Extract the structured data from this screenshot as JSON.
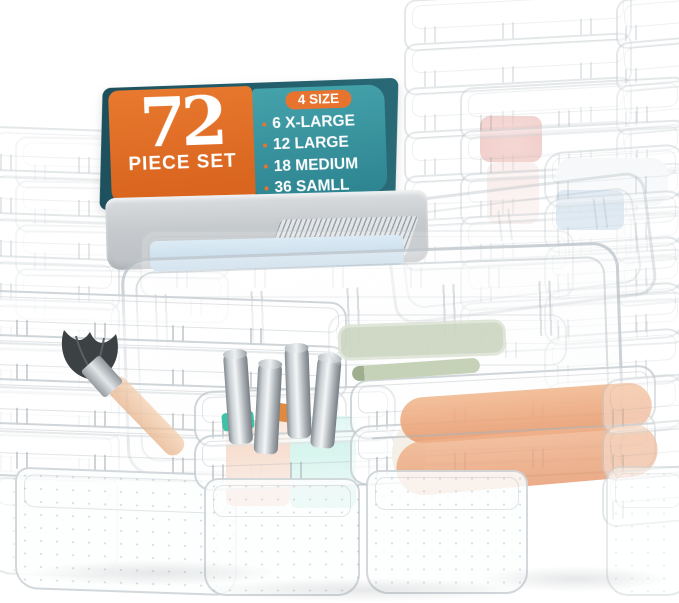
{
  "banner": {
    "piece_count": "72",
    "piece_count_label": "PIECE SET",
    "size_badge": "4 SIZE",
    "sizes": [
      "6 X-LARGE",
      "12 LARGE",
      "18 MEDIUM",
      "36 SAMLL"
    ],
    "colors": {
      "orange": "#DD6B2D",
      "teal": "#35909D",
      "dark_teal": "#1E515E",
      "text_white": "#FFFFFF"
    }
  },
  "scene": {
    "object_names": [
      "clear-organizer-tray-stacks",
      "gray-organizer-tray",
      "makeup-brush",
      "silver-lipstick-tubes",
      "peach-cosmetic-rolls",
      "mint-cosmetic-block",
      "peach-cosmetic-block",
      "sage-palette",
      "sage-pen",
      "red-cosmetic",
      "blue-cosmetic",
      "light-blue-tray-liner"
    ],
    "colors": {
      "tray_outline": "#AEB8BE",
      "gray_tray": "#C6CACD",
      "light_blue": "#CBDFEE",
      "mint": "#9BE4D2",
      "peach": "#EFB090",
      "red": "#DD8078",
      "blue": "#B9D0E3",
      "sage": "#CCD6C2",
      "silver": "#C9CFD3",
      "brush_bristles": "#3C4144",
      "brush_handle": "#EDBD96"
    }
  }
}
